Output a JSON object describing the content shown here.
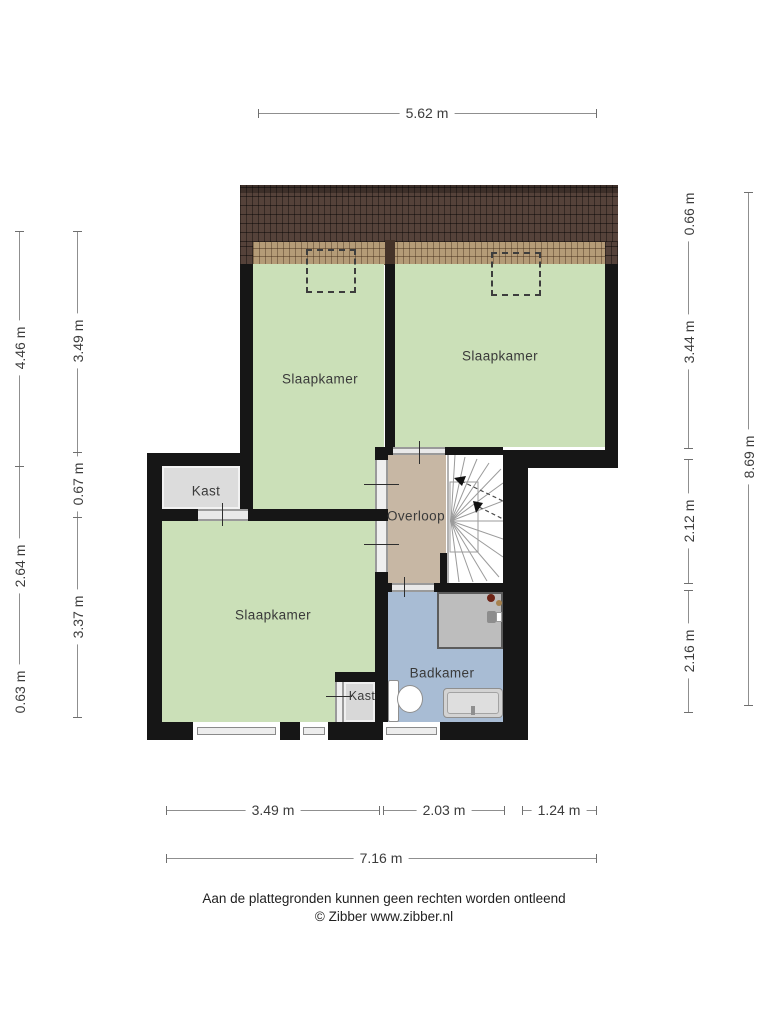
{
  "plan": {
    "rooms": {
      "bedroom_top_left": {
        "label": "Slaapkamer"
      },
      "bedroom_top_right": {
        "label": "Slaapkamer"
      },
      "bedroom_bottom": {
        "label": "Slaapkamer"
      },
      "closet_upper": {
        "label": "Kast"
      },
      "closet_lower": {
        "label": "Kast"
      },
      "landing": {
        "label": "Overloop"
      },
      "bathroom": {
        "label": "Badkamer"
      }
    },
    "colors": {
      "wall": "#161616",
      "bedroom_green": "#cbe0b8",
      "landing_tan": "#c7b7a4",
      "bathroom_blue": "#a8bcd4",
      "closet_gray": "#dcdcdc",
      "roof_dark": "#55423a",
      "roof_light": "#b49b77"
    },
    "dimensions": {
      "top_width": "5.62 m",
      "left_outer": [
        "4.46 m",
        "2.64 m",
        "0.63 m"
      ],
      "left_inner": [
        "3.49 m",
        "0.67 m",
        "3.37 m"
      ],
      "right_inner": [
        "0.66 m",
        "3.44 m",
        "2.12 m",
        "2.16 m"
      ],
      "right_outer": "8.69 m",
      "bottom_segments": [
        "3.49 m",
        "2.03 m",
        "1.24 m"
      ],
      "bottom_total": "7.16 m"
    },
    "footer": {
      "disclaimer": "Aan de plattegronden kunnen geen rechten worden ontleend",
      "copyright": "© Zibber www.zibber.nl"
    }
  }
}
